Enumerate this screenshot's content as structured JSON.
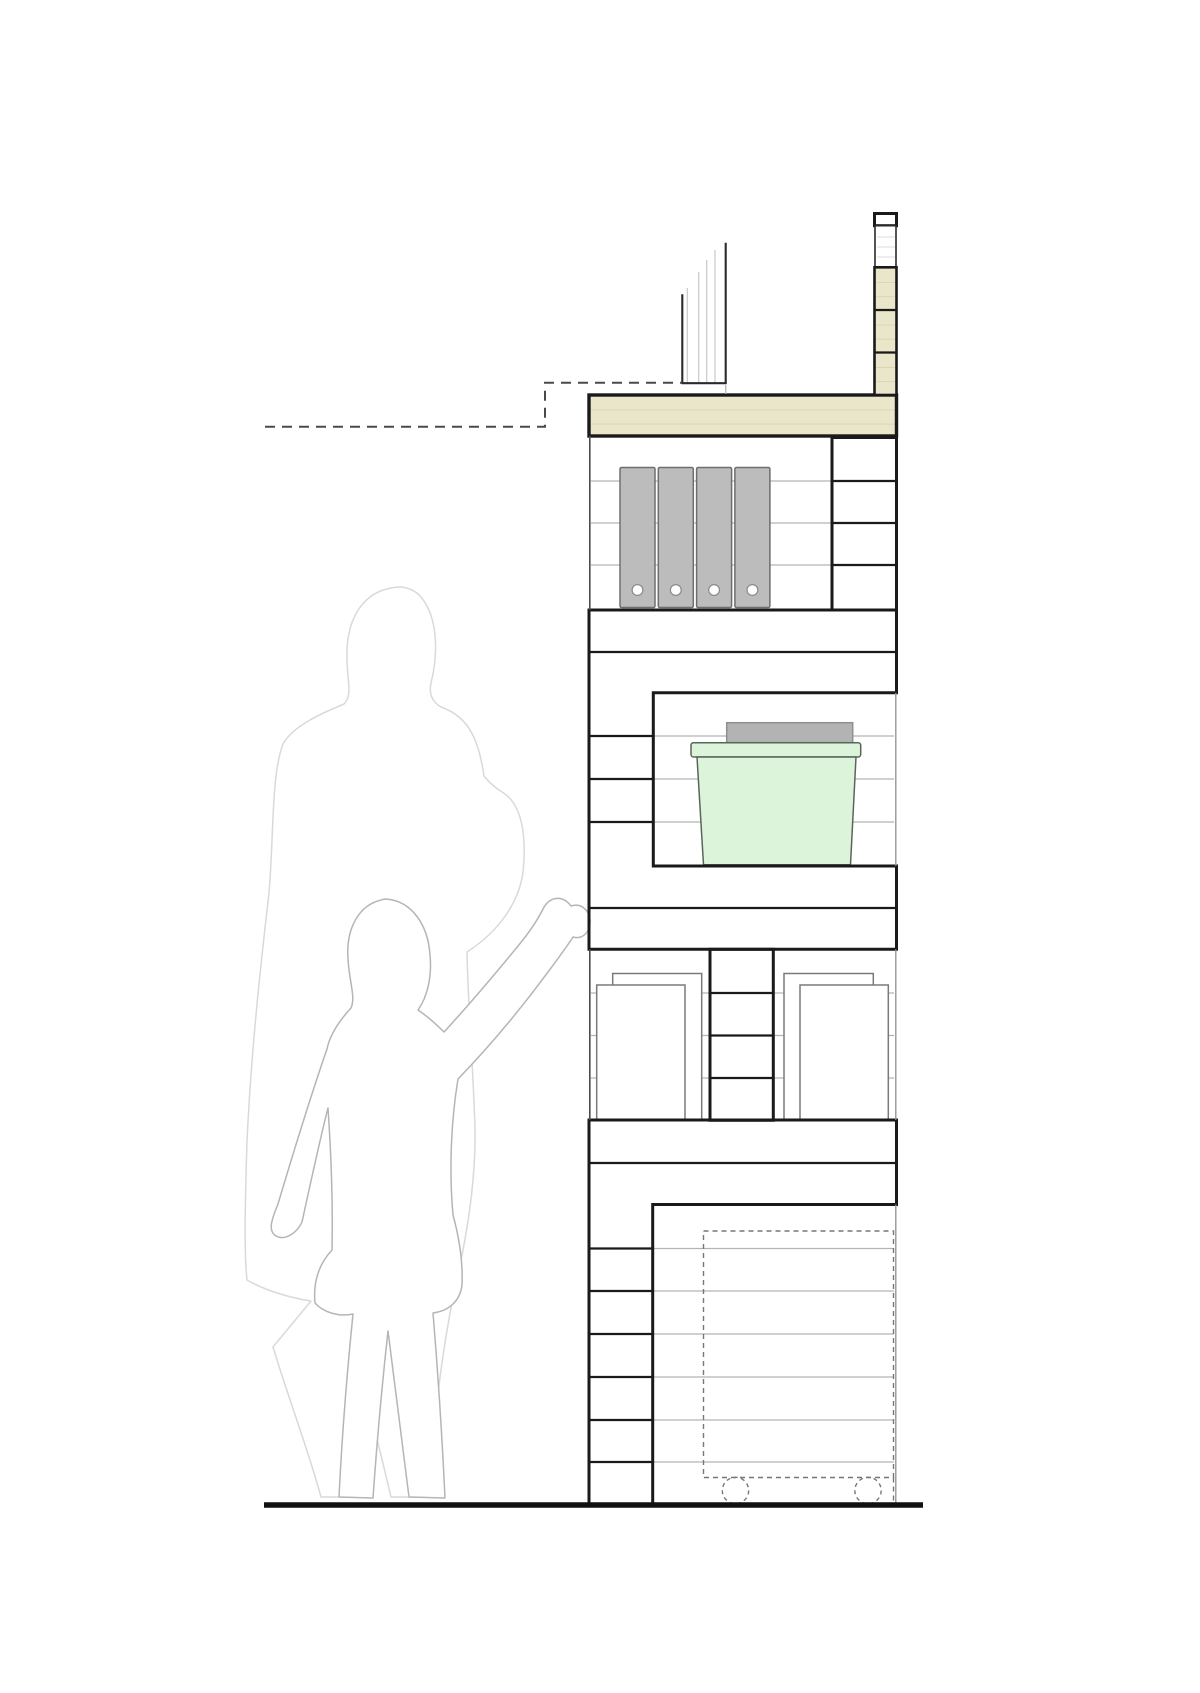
{
  "page": {
    "background": "#ffffff",
    "kind": "architectural-section-drawing"
  },
  "colors": {
    "wood_fill": "#eae6ca",
    "wood_course_line": "#d8d3b6",
    "outline": "#1a1a1a",
    "back_wall_line": "#b3b3b3",
    "thin_edge": "#8f8f8f",
    "binder_fill": "#bcbcbc",
    "binder_border": "#6e6e6e",
    "lid_fill": "#b3b3b3",
    "lid_border": "#8f8f8f",
    "bin_fill": "#dcf5da",
    "bin_border": "#5a655a",
    "adult_outline": "#d9d9d9",
    "child_outline": "#b5b5b5",
    "dashed_profile": "#4a4a4a",
    "dashed_cart": "#777777",
    "ground": "#111111"
  },
  "elements": {
    "shelf_unit": "staggered timber shelving wall in section",
    "binders": {
      "count": 4
    },
    "storage_boxes": {
      "count": 4
    },
    "storage_bin": {
      "count": 1,
      "lid": true
    },
    "cart": {
      "dashed_outline": true,
      "wheel_count": 2
    },
    "figures": {
      "adult": "standing adult outline",
      "child": "child outline with raised arm"
    },
    "railing": {
      "post_count": 2,
      "infill_line_count": 4
    },
    "dashed_profile_line": "stepped hidden-line at upper left",
    "parapet": "narrow capped column at top right"
  }
}
